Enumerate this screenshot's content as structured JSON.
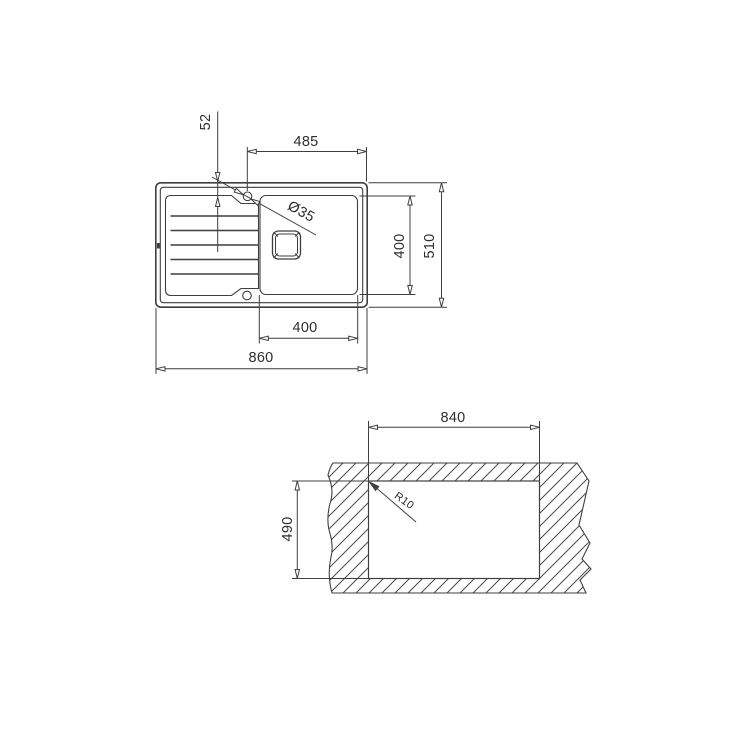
{
  "top_view": {
    "hole_offset": "52",
    "hole_to_edge": "485",
    "hole_diameter": "Ø35",
    "bowl_length": "400",
    "overall_depth": "510",
    "bowl_width": "400",
    "overall_width": "860"
  },
  "cutout_view": {
    "cutout_width": "840",
    "cutout_depth": "490",
    "corner_radius": "R10"
  },
  "colors": {
    "line": "#3f3f3f",
    "text": "#2e2e2e",
    "background": "#ffffff"
  }
}
